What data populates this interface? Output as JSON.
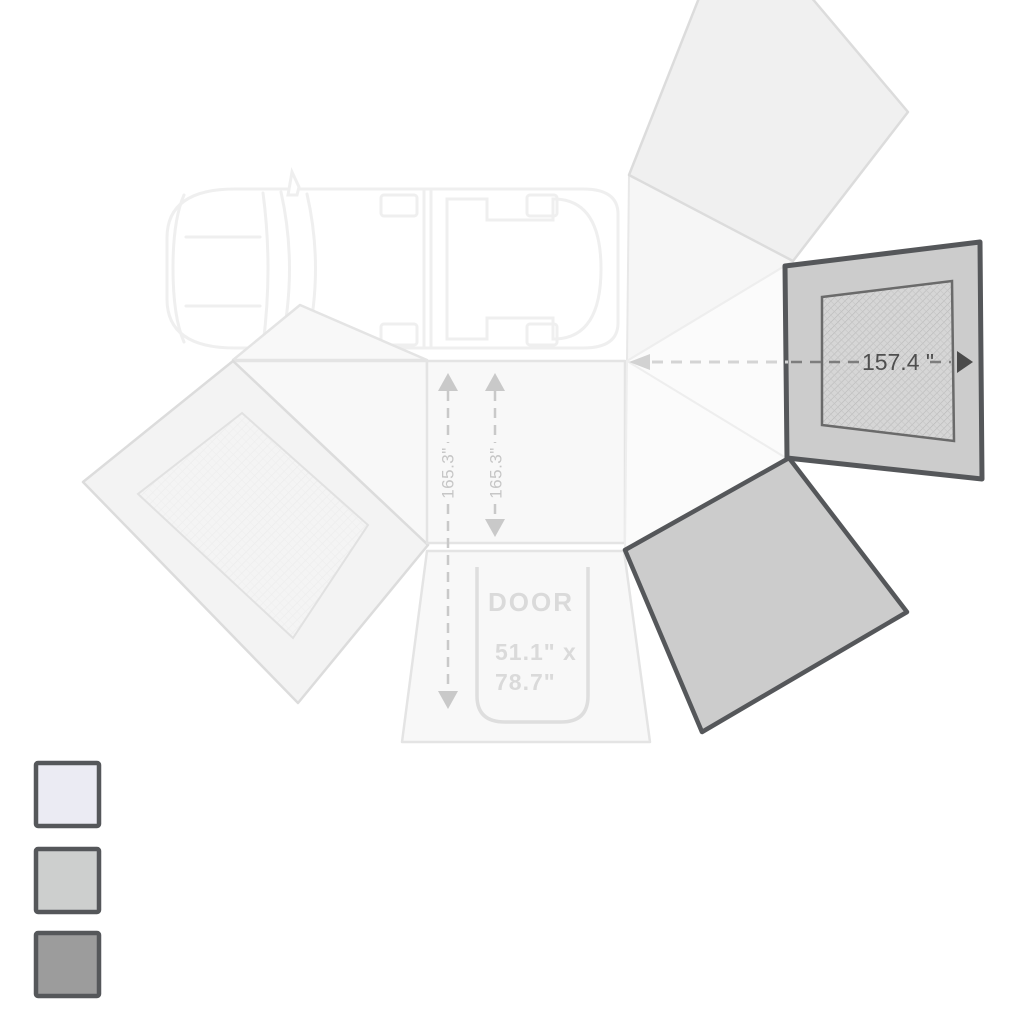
{
  "diagram": {
    "awning": {
      "width_label": "157.4 \"",
      "projection_label_left": "165.3\"",
      "projection_label_right": "165.3\"",
      "door_label": "DOOR",
      "door_size_line1": "51.1\" x",
      "door_size_line2": "78.7\""
    },
    "colors": {
      "wall_fill": "#cccccc",
      "wall_border": "#55575a",
      "mesh_fill": "#d6d6d6",
      "canopy_fill": "#f8f8f8",
      "canopy_outline": "#e4e4e4",
      "dim_text_dark": "#4f4f4f",
      "dim_text_light": "#c6c6c6",
      "door_text": "#dadada"
    }
  },
  "legend": {
    "swatches": [
      {
        "name": "light",
        "fill": "#ebebf3"
      },
      {
        "name": "medium",
        "fill": "#cdcfce"
      },
      {
        "name": "dark",
        "fill": "#9c9c9c"
      }
    ],
    "border": "#55575a"
  }
}
